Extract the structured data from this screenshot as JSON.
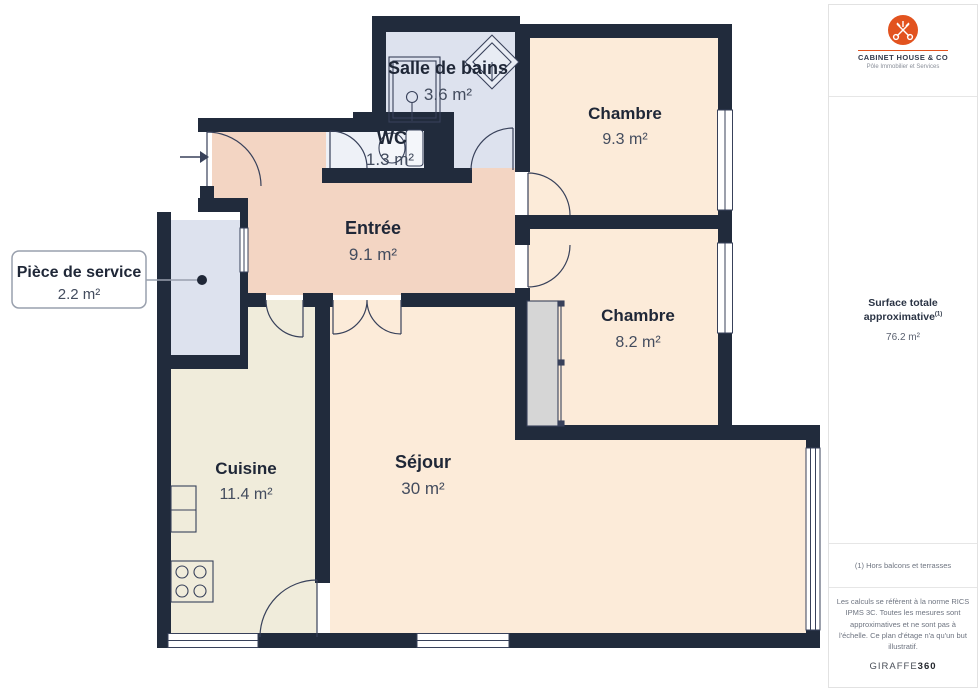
{
  "rooms": {
    "bath": {
      "name": "Salle de bains",
      "area": "3.6 m²"
    },
    "wc": {
      "name": "WC",
      "area": "1.3 m²"
    },
    "bedroom1": {
      "name": "Chambre",
      "area": "9.3 m²"
    },
    "entry": {
      "name": "Entrée",
      "area": "9.1 m²"
    },
    "service": {
      "name": "Pièce de service",
      "area": "2.2 m²"
    },
    "bedroom2": {
      "name": "Chambre",
      "area": "8.2 m²"
    },
    "kitchen": {
      "name": "Cuisine",
      "area": "11.4 m²"
    },
    "living": {
      "name": "Séjour",
      "area": "30 m²"
    }
  },
  "sidebar": {
    "brand": {
      "name": "CABINET HOUSE & CO",
      "tagline": "Pôle Immobilier et Services"
    },
    "surface": {
      "label": "Surface totale approximative",
      "sup": "(1)",
      "value": "76.2 m²"
    },
    "footnote": "(1) Hors balcons et terrasses",
    "disclaimer": "Les calculs se réfèrent à la norme RICS IPMS 3C. Toutes les mesures sont approximatives et ne sont pas à l'échelle. Ce plan d'étage n'a qu'un but illustratif.",
    "watermark_regular": "GIRAFFE",
    "watermark_bold": "360"
  },
  "colors": {
    "wall": "#212b3c",
    "room_peach": "#fcebd9",
    "room_salmon": "#f3d5c3",
    "room_cream": "#f0ecdb",
    "room_lightblue": "#dde2ee",
    "room_wc": "#eef1f7",
    "closet_gray": "#d6d6d6",
    "brand_orange": "#e2531f"
  }
}
